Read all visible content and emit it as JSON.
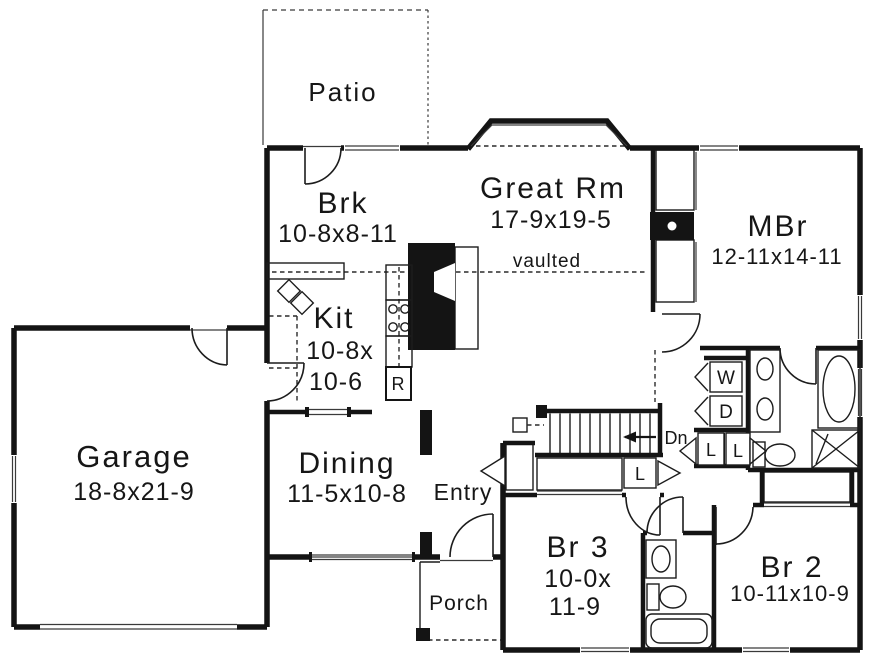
{
  "rooms": {
    "patio": {
      "name": "Patio"
    },
    "breakfast": {
      "name": "Brk",
      "dims": "10-8x8-11"
    },
    "great_room": {
      "name": "Great Rm",
      "dims": "17-9x19-5",
      "ceiling": "vaulted"
    },
    "master_bedroom": {
      "name": "MBr",
      "dims": "12-11x14-11"
    },
    "kitchen": {
      "name": "Kit",
      "dims_line1": "10-8x",
      "dims_line2": "10-6"
    },
    "garage": {
      "name": "Garage",
      "dims": "18-8x21-9"
    },
    "dining": {
      "name": "Dining",
      "dims": "11-5x10-8"
    },
    "entry": {
      "name": "Entry"
    },
    "porch": {
      "name": "Porch"
    },
    "bedroom3": {
      "name": "Br 3",
      "dims_line1": "10-0x",
      "dims_line2": "11-9"
    },
    "bedroom2": {
      "name": "Br 2",
      "dims": "10-11x10-9"
    }
  },
  "fixtures": {
    "washer": "W",
    "dryer": "D",
    "linen": "L",
    "refrigerator": "R",
    "stairs_direction": "Dn"
  },
  "colors": {
    "line": "#141414",
    "background": "#ffffff"
  }
}
